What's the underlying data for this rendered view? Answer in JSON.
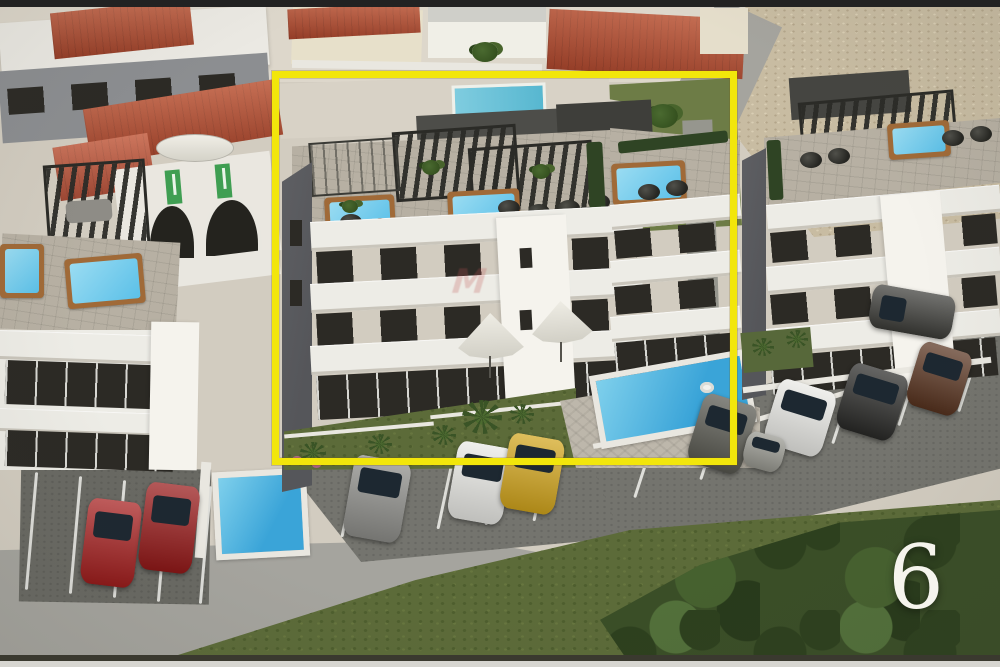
{
  "image": {
    "kind": "aerial 3D architectural render, real-estate listing photo",
    "photo_number": "6",
    "watermark_text": "M"
  },
  "annotation": {
    "highlight_box": "yellow rectangle outlining the featured apartment building"
  },
  "scene": {
    "featured_building": "three-storey white apartment building with rooftop terrace, black pergolas, hot tubs and round loungers",
    "surroundings": [
      "left apartment building with rooftop hot tub",
      "villa with terracotta roof, white parasol and arched windows",
      "right apartment building with rooftop pergola",
      "gray townhouses with red hip roof",
      "gravel field top right",
      "lawns, palms and dense foliage bottom right"
    ],
    "pools": [
      "ground-level pool of featured building",
      "lap pool behind featured building",
      "pool beside left building",
      "rooftop hot tubs"
    ],
    "vehicles": [
      "red car",
      "red car",
      "gray car",
      "white car",
      "yellow car",
      "dark gray car",
      "white suv",
      "black car",
      "brown car",
      "dark suv",
      "small gray car"
    ]
  },
  "colors": {
    "highlight": "#f2e60b",
    "bar-dark": "#222222",
    "bottom-line": "#3a392f",
    "strip-light": "#d7d6d1",
    "base": "#d2ccc0",
    "top-backdrop": "#ddd7cb",
    "gravel": "#c8bca2",
    "road": "#a5a49e",
    "asphalt": "#74746e",
    "grass": "#5c6b39",
    "lawn": "#6d7c46",
    "foliage": "#3a4e27",
    "deck": "#b7b0a3",
    "stone": "#cfc8ba",
    "facade": "#edece6",
    "facade-bright": "#f5f3ed",
    "band-shadow": "#c9c5bb",
    "wall-gray": "#8c8e91",
    "side-gray": "#55565a",
    "roof-red": "#a8452c",
    "cream": "#e7e0ca",
    "white-house": "#f0efe7",
    "pool-water": "#3aa4d8",
    "pool-light": "#7fd0ec",
    "spa-water": "#5bc0e8",
    "wood": "#a06a38",
    "pergola": "#2b2b27",
    "window": "#2c2a25",
    "white-wall": "#e9e7e0",
    "hedge": "#2f4424",
    "flag-green": "#3f9e52",
    "number": "#f5f4ed",
    "watermark": "rgba(186,80,80,0.25)",
    "car-red": "#a81d1d",
    "car-red2": "#971818",
    "car-gray": "#8e8e8a",
    "car-white": "#e9e9e5",
    "car-yellow": "#d2a51d",
    "car-coupe": "#57574f",
    "car-black": "#2a2a28",
    "car-brown": "#58331f",
    "car-suv": "#3c3c38",
    "car-small": "#97978f"
  }
}
